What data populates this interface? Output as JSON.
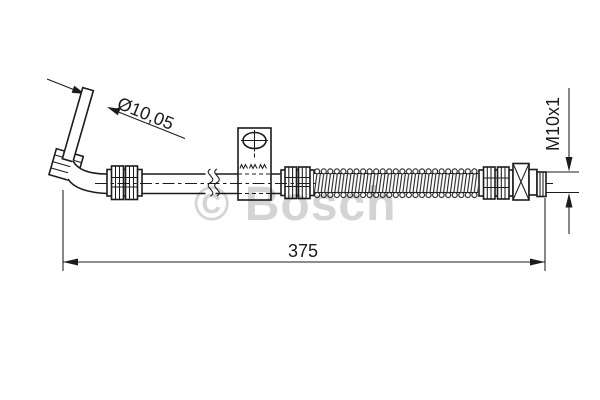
{
  "drawing": {
    "annotations": {
      "diameter": "Ø10,05",
      "thread": "M10x1",
      "length": "375"
    },
    "watermark": "© Bosch",
    "colors": {
      "line": "#1c1c1c",
      "watermark": "#d4d4d4",
      "background": "#ffffff"
    }
  }
}
